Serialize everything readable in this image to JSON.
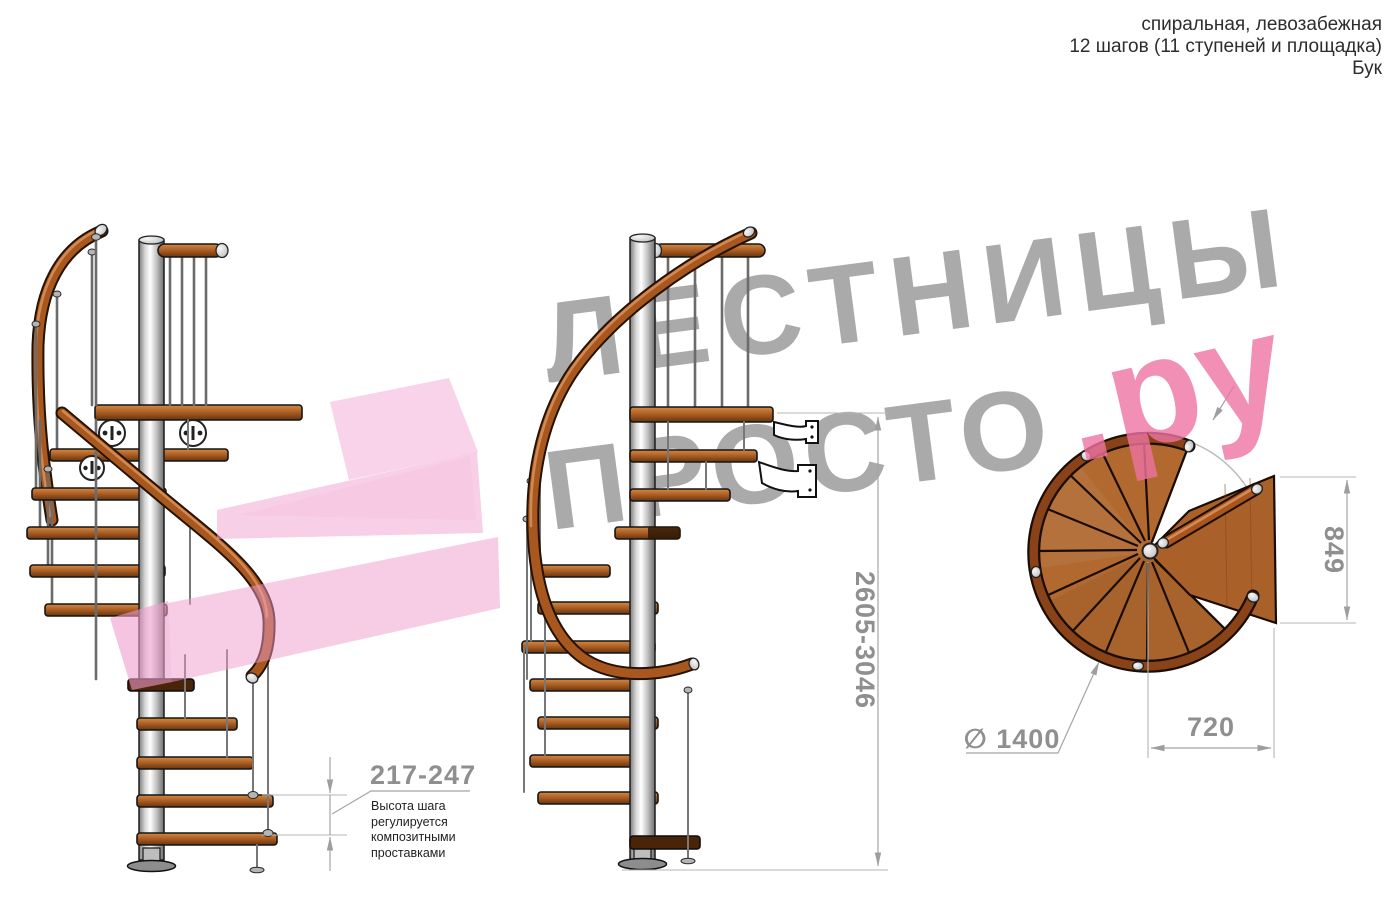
{
  "header": {
    "line1": "спиральная, левозабежная",
    "line2": "12 шагов (11 ступеней и площадка)",
    "line3": "Бук"
  },
  "watermark": {
    "brand_top": "ЛЕСТНИЦЫ",
    "brand_bottom": "ПРОСТО",
    "brand_suffix": ".ру"
  },
  "dimensions": {
    "step_height": {
      "value": "217-247",
      "note": "Высота шага регулируется композитными проставками"
    },
    "total_height": {
      "value": "2605-3046"
    },
    "landing_depth": {
      "value": "849"
    },
    "landing_width": {
      "value": "720"
    },
    "stair_diameter": {
      "value": "∅ 1400"
    }
  },
  "colors": {
    "wood": "#a8571e",
    "metal": "#c9c9c9",
    "watermark_gray": "#9c9c9c",
    "watermark_pink": "#ee74a3",
    "arrow_pink": "#f1a7d4",
    "dimension_gray": "#8f8f8f"
  }
}
